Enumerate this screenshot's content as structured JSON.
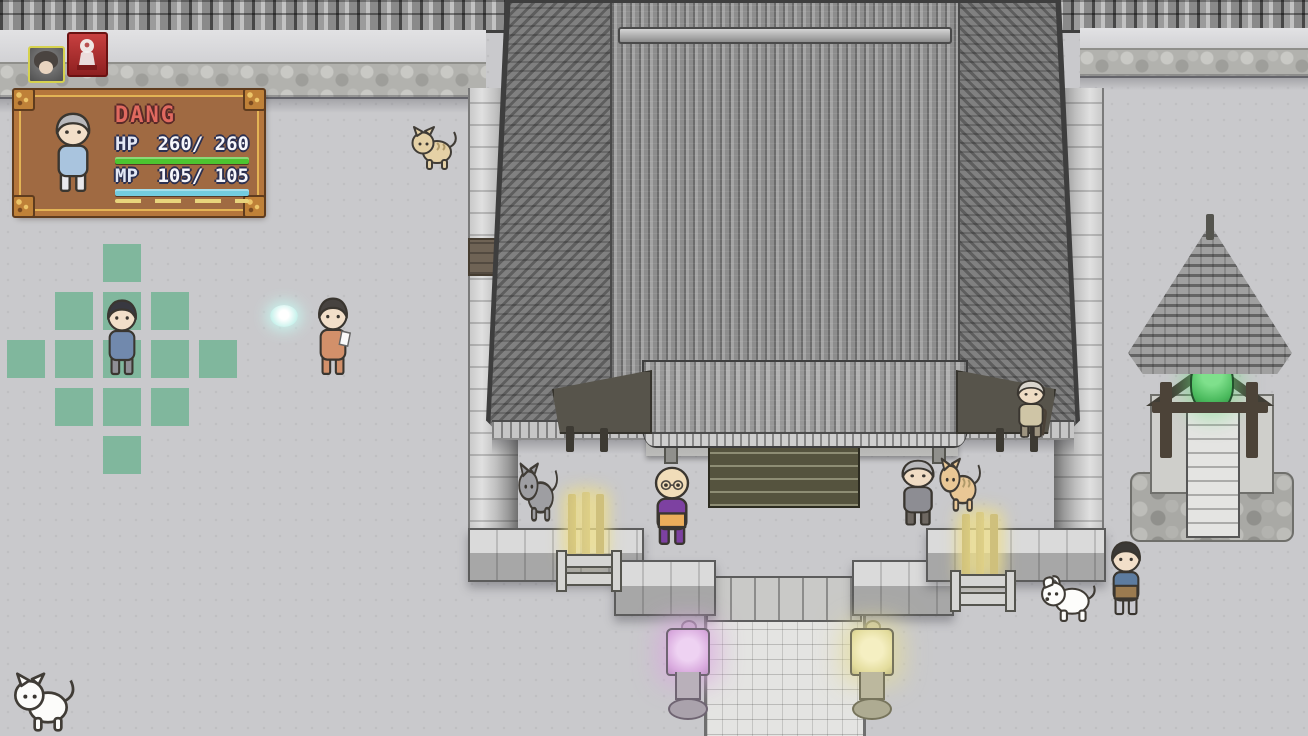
{
  "hud": {
    "party_icons": [
      {
        "id": "player-portrait-icon",
        "border_color": "#d6d24e",
        "hair": "#4a4440",
        "skin": "#e8d4c0"
      },
      {
        "id": "spirit-marker-icon",
        "bg": "#c23838",
        "figure_color": "#f2f0ee"
      }
    ],
    "status_panel": {
      "name": "DANG",
      "name_color": "#e0695f",
      "hp": {
        "label": "HP",
        "display": "260/ 260",
        "current": 260,
        "max": 260,
        "bar_color": "#4cc430"
      },
      "mp": {
        "label": "MP",
        "display": "105/ 105",
        "current": 105,
        "max": 105,
        "bar_color": "#74ccdf"
      },
      "portrait": {
        "hair": "#b9b9bc",
        "skin": "#f2dfc9",
        "top": "#a9c4de",
        "bottom": "#e9e9ed"
      }
    }
  },
  "movement_grid": {
    "color": "#7cb69a",
    "tile": 38,
    "pitch": 48,
    "origin_x": 122,
    "origin_y": 359,
    "cells": [
      [
        0,
        -2
      ],
      [
        -1,
        -1
      ],
      [
        0,
        -1
      ],
      [
        1,
        -1
      ],
      [
        -2,
        0
      ],
      [
        -1,
        0
      ],
      [
        0,
        0
      ],
      [
        1,
        0
      ],
      [
        2,
        0
      ],
      [
        -1,
        1
      ],
      [
        0,
        1
      ],
      [
        1,
        1
      ],
      [
        0,
        2
      ]
    ]
  },
  "entities": [
    {
      "id": "player-character",
      "type": "person",
      "x": 103,
      "y": 294,
      "w": 38,
      "h": 84,
      "hair": "#383840",
      "skin": "#f2dfc9",
      "top": "#7189ad",
      "bottom": "#8f8f96"
    },
    {
      "id": "npc-paper-visitor",
      "type": "person",
      "x": 314,
      "y": 292,
      "w": 38,
      "h": 86,
      "hair": "#474340",
      "skin": "#f2dfc9",
      "top": "#d2906a",
      "bottom": "#d2906a",
      "item": true
    },
    {
      "id": "npc-monk",
      "type": "person",
      "x": 650,
      "y": 460,
      "w": 44,
      "h": 88,
      "hair": null,
      "skin": "#f1ddb9",
      "top": "#7d41a1",
      "bottom": "#7d41a1",
      "sash": "#ecae5b",
      "glasses": true
    },
    {
      "id": "npc-old-woman",
      "type": "person",
      "x": 897,
      "y": 455,
      "w": 42,
      "h": 73,
      "hair": "#b9b9bc",
      "skin": "#f0dcc4",
      "top": "#8d8d93",
      "bottom": "#6e6862"
    },
    {
      "id": "npc-old-man-cane",
      "type": "person",
      "x": 1013,
      "y": 376,
      "w": 36,
      "h": 64,
      "hair": "#d9d5cd",
      "skin": "#eedcc4",
      "top": "#cfc5a6",
      "bottom": "#9d9480",
      "cane": "#4b4238"
    },
    {
      "id": "npc-suit-man",
      "type": "person",
      "x": 1107,
      "y": 536,
      "w": 38,
      "h": 82,
      "hair": "#3b3936",
      "skin": "#f2dfc9",
      "top": "#5d7ca0",
      "bottom": "#c9c9cf",
      "sash": "#9b7b50"
    },
    {
      "id": "cat-tan",
      "type": "cat",
      "x": 410,
      "y": 119,
      "w": 48,
      "h": 52,
      "color": "#e5d1a6",
      "stripes": true
    },
    {
      "id": "cat-gray",
      "type": "cat",
      "x": 517,
      "y": 453,
      "w": 42,
      "h": 70,
      "color": "#9e9ea2",
      "stripes": false
    },
    {
      "id": "cat-orange",
      "type": "cat",
      "x": 938,
      "y": 449,
      "w": 44,
      "h": 64,
      "color": "#e9c795",
      "stripes": true
    },
    {
      "id": "dog-white",
      "type": "dog",
      "x": 1040,
      "y": 568,
      "w": 58,
      "h": 54,
      "color": "#fdfdfb"
    },
    {
      "id": "cat-white",
      "type": "cat",
      "x": 12,
      "y": 663,
      "w": 64,
      "h": 70,
      "color": "#fcfcfa",
      "stripes": false
    },
    {
      "id": "spirit-orb",
      "type": "orb",
      "x": 270,
      "y": 305,
      "w": 28,
      "h": 22,
      "color": "#c8f2ec"
    }
  ],
  "environment": {
    "ground_color": "#c9c9cc",
    "grid_color": "#7cb69a",
    "lantern_left_glow": "#d9aade",
    "lantern_right_glow": "#e3dc9c",
    "incense_glow": "#efe08a",
    "bell_color": "#49b95c",
    "orb_color": "#c8f2ec"
  }
}
